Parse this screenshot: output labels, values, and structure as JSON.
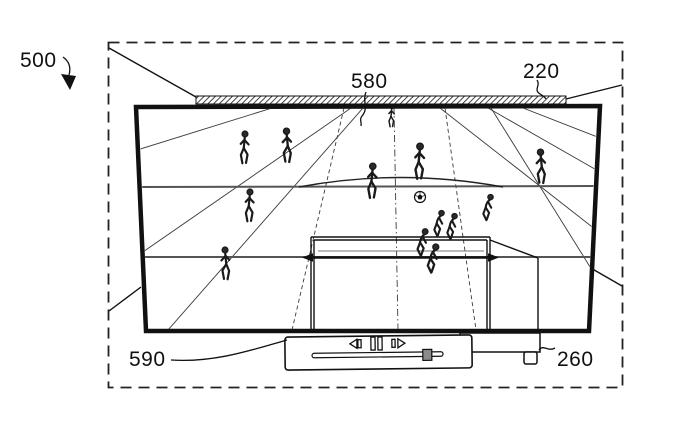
{
  "figure": {
    "kind": "patent-line-drawing",
    "ink_color": "#111111",
    "background_color": "#ffffff",
    "reference_labels": {
      "system": "500",
      "screen_content": "580",
      "display_device": "220",
      "playback_controls": "590",
      "display_stand": "260"
    }
  },
  "scene": {
    "description": "soccer match rendered on television screen",
    "players": [
      {
        "pose": "walk",
        "x": 235,
        "y": 130,
        "h": 38,
        "flip": false
      },
      {
        "pose": "walk",
        "x": 277,
        "y": 127,
        "h": 40,
        "flip": true
      },
      {
        "pose": "walk",
        "x": 362,
        "y": 162,
        "h": 41,
        "flip": false
      },
      {
        "pose": "walk",
        "x": 409,
        "y": 142,
        "h": 42,
        "flip": false
      },
      {
        "pose": "walk",
        "x": 531,
        "y": 148,
        "h": 40,
        "flip": true
      },
      {
        "pose": "walk",
        "x": 240,
        "y": 188,
        "h": 38,
        "flip": false
      },
      {
        "pose": "walk",
        "x": 216,
        "y": 246,
        "h": 38,
        "flip": true
      },
      {
        "pose": "crouch",
        "x": 430,
        "y": 205,
        "h": 36,
        "flip": false
      },
      {
        "pose": "crouch",
        "x": 443,
        "y": 208,
        "h": 36,
        "flip": false
      },
      {
        "pose": "crouch",
        "x": 413,
        "y": 223,
        "h": 38,
        "flip": false
      },
      {
        "pose": "crouch",
        "x": 423,
        "y": 238,
        "h": 40,
        "flip": false
      },
      {
        "pose": "crouch",
        "x": 479,
        "y": 189,
        "h": 36,
        "flip": false
      },
      {
        "pose": "walk",
        "x": 385,
        "y": 104,
        "h": 26,
        "flip": false
      }
    ],
    "ball": {
      "x": 420,
      "y": 197,
      "r": 5.5
    }
  },
  "player_bar": {
    "icons": [
      "rewind-icon",
      "pause-icon",
      "fast-forward-icon"
    ],
    "slider_fraction": 0.88
  }
}
